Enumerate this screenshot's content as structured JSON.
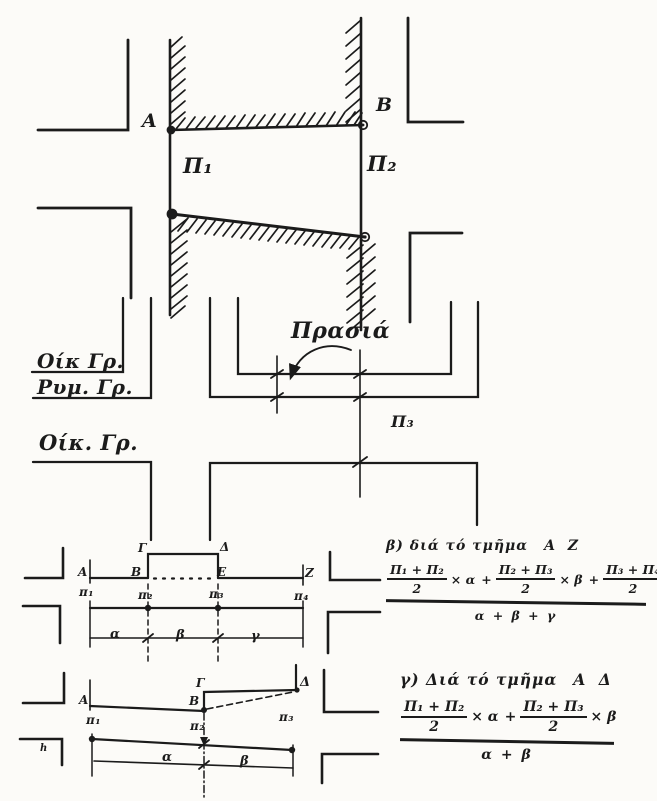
{
  "page": {
    "paper_color": "#fcfbf8",
    "ink_color": "#1b1b1b"
  },
  "top_diagram": {
    "point_a": "A",
    "point_b": "B",
    "width_p1": "Π₁",
    "width_p2": "Π₂"
  },
  "middle_diagram": {
    "building_line_label_top": "Οίκ Γρ.",
    "street_line_label": "Ρυμ. Γρ.",
    "building_line_label_bottom": "Οίκ. Γρ.",
    "front_garden_label": "Πρασιά",
    "width_p3": "Π₃"
  },
  "segment_az_diagram": {
    "point_a": "A",
    "point_b": "Β",
    "point_g": "Γ",
    "point_d": "Δ",
    "point_e": "Ε",
    "point_z": "Ζ",
    "pi1": "π₁",
    "pi2": "π₂",
    "pi3": "π₃",
    "pi4": "π₄",
    "seg_a": "α",
    "seg_b": "β",
    "seg_g": "γ"
  },
  "segment_ad_diagram": {
    "point_a": "A",
    "point_b": "Β",
    "point_g": "Γ",
    "point_d": "Δ",
    "pi1": "π₁",
    "pi2": "π₂",
    "pi3": "π₃",
    "seg_a": "α",
    "seg_b": "β",
    "stray_mark": "h"
  },
  "formula_az": {
    "heading_prefix": "β) διά τό τμῆμα",
    "heading_segment": "Α Ζ",
    "num1": "Π₁ + Π₂",
    "num2": "Π₂ + Π₃",
    "num3": "Π₃ + Π₄",
    "half": "2",
    "mul1": "× α",
    "mul2": "× β",
    "mul3": "× γ",
    "plus": "+",
    "denominator": "α + β + γ"
  },
  "formula_ad": {
    "heading_prefix": "γ) Διά τό τμῆμα",
    "heading_segment": "Α Δ",
    "num1": "Π₁ + Π₂",
    "num2": "Π₂ + Π₃",
    "half": "2",
    "mul1": "× α",
    "mul2": "× β",
    "plus": "+",
    "denominator": "α + β"
  }
}
